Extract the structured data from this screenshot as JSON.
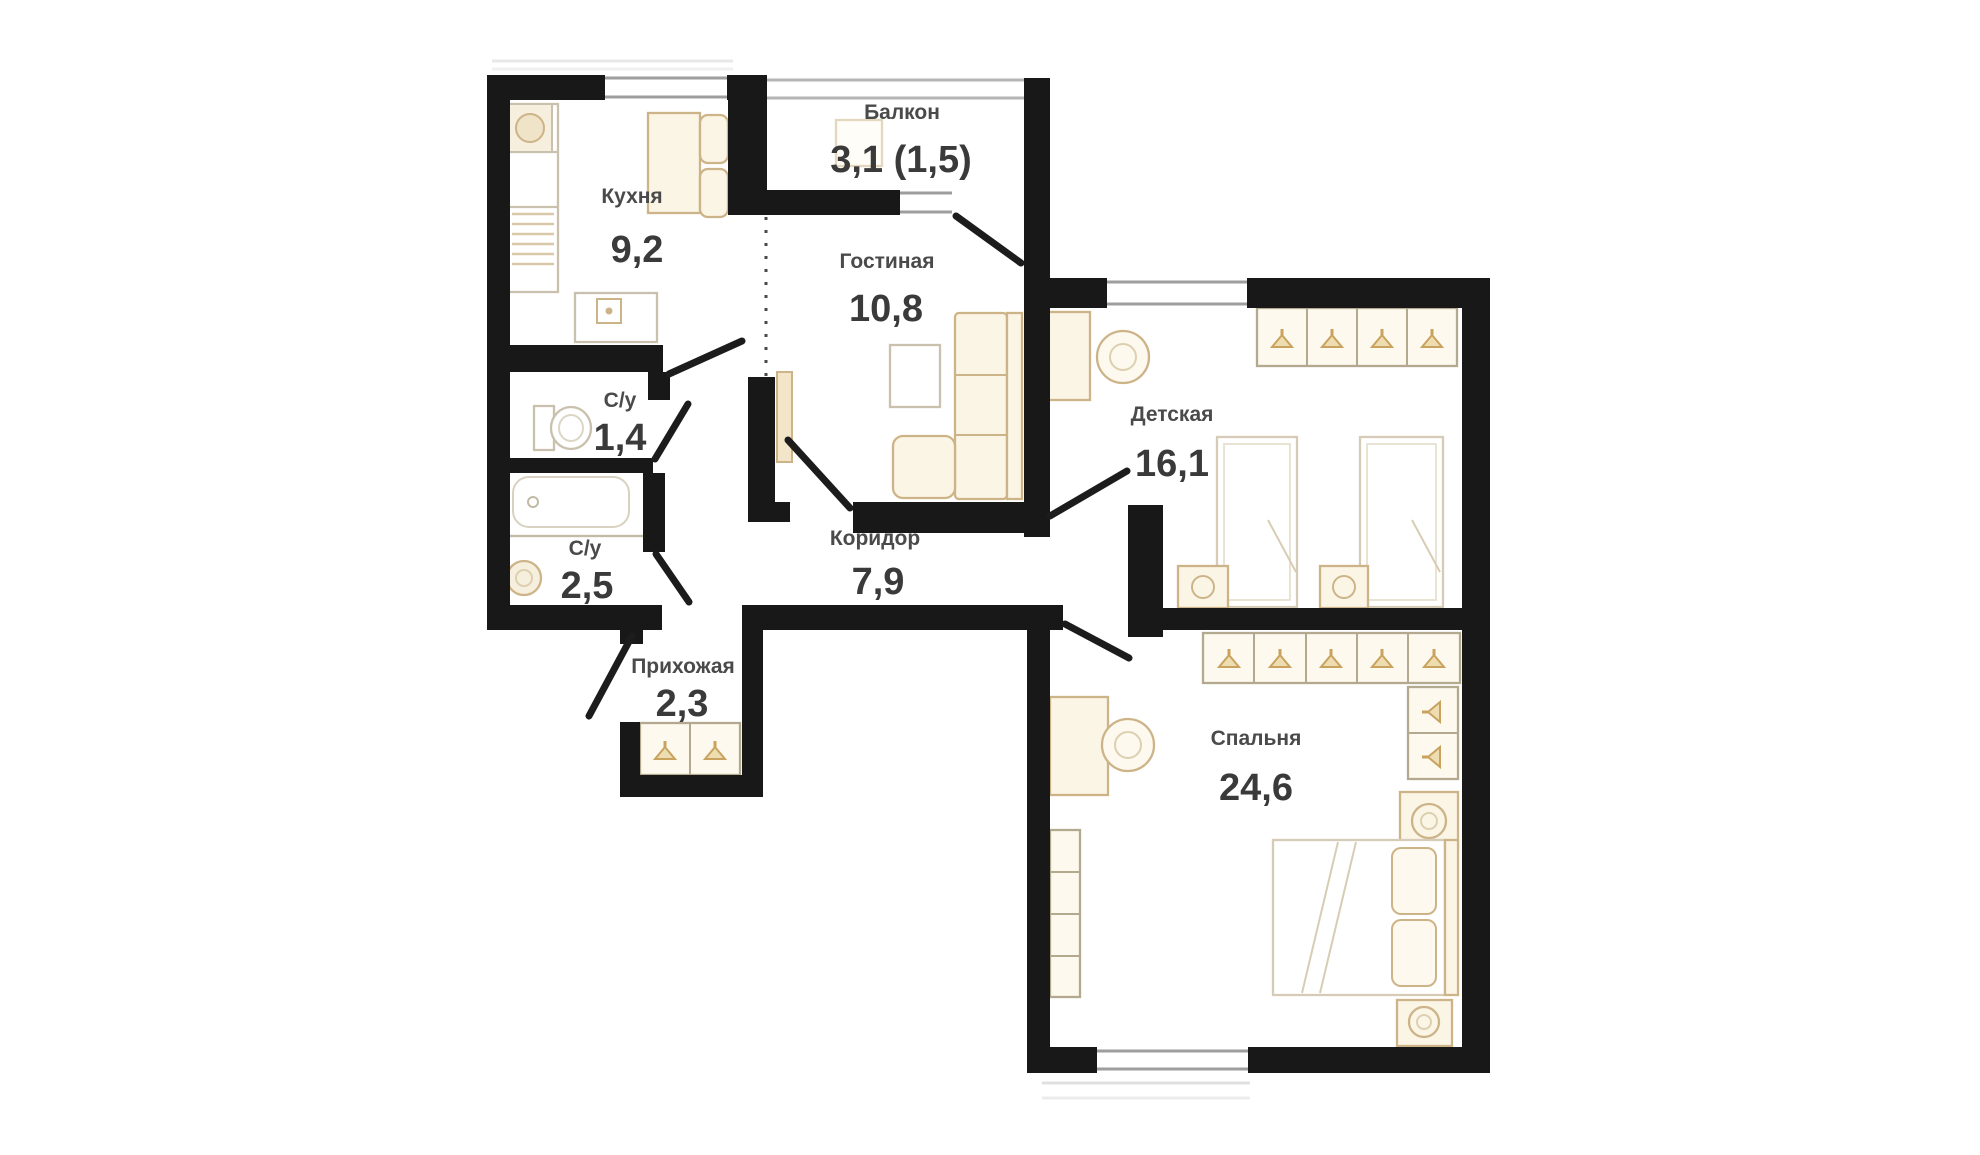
{
  "plan": {
    "colors": {
      "wall": "#181818",
      "window_line": "#9e9e9e",
      "furniture_stroke": "#cdb488",
      "furniture_fill": "#fbf5e6",
      "label_color": "#4a4a4a",
      "number_color": "#3a3a3a",
      "background": "#ffffff"
    },
    "rooms": [
      {
        "id": "kitchen",
        "name": "Кухня",
        "area": "9,2"
      },
      {
        "id": "balcony",
        "name": "Балкон",
        "area": "3,1 (1,5)"
      },
      {
        "id": "living",
        "name": "Гостиная",
        "area": "10,8"
      },
      {
        "id": "wc",
        "name": "С/у",
        "area": "1,4"
      },
      {
        "id": "bathroom",
        "name": "С/у",
        "area": "2,5"
      },
      {
        "id": "corridor",
        "name": "Коридор",
        "area": "7,9"
      },
      {
        "id": "hallway",
        "name": "Прихожая",
        "area": "2,3"
      },
      {
        "id": "children",
        "name": "Детская",
        "area": "16,1"
      },
      {
        "id": "bedroom",
        "name": "Спальня",
        "area": "24,6"
      }
    ]
  }
}
